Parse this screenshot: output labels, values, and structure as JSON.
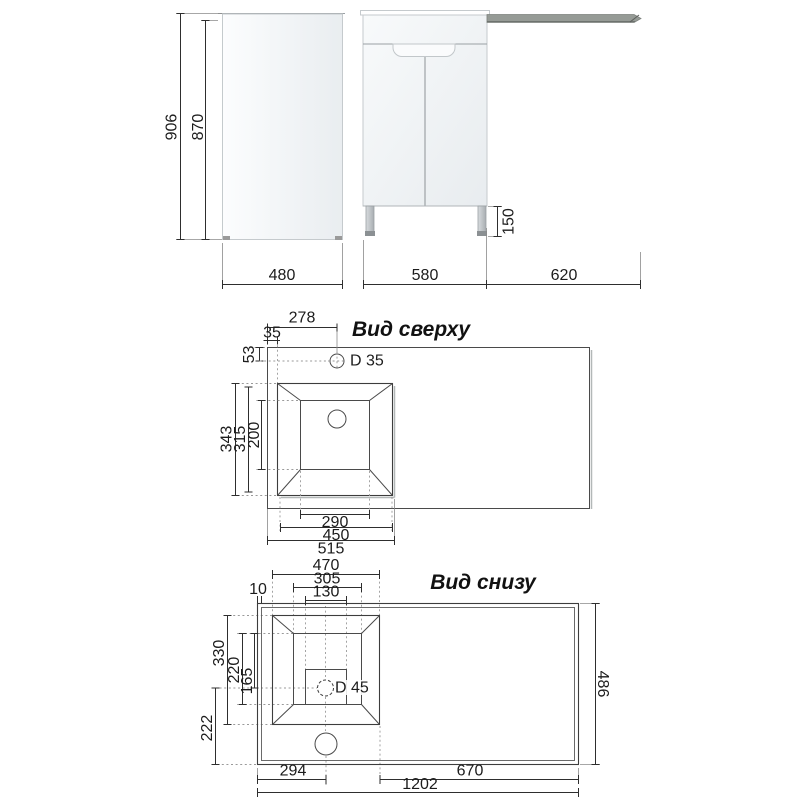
{
  "front_view": {
    "overall_height": "906",
    "cabinet_height": "870",
    "leg_height": "150",
    "side_depth": "480",
    "cabinet_width": "580",
    "worktop_wing_width": "620"
  },
  "top_view": {
    "title": "Вид сверху",
    "faucet_center_from_left": "278",
    "sink_edge_inset": "35",
    "faucet_center_from_back": "53",
    "faucet_hole_diameter": "D 35",
    "sink_outer_depth": "343",
    "sink_rim_depth": "315",
    "bowl_depth": "200",
    "bowl_width": "290",
    "sink_rim_width": "450",
    "sink_outer_width": "515"
  },
  "bottom_view": {
    "title": "Вид снизу",
    "sink_outer_width": "470",
    "bowl_width": "305",
    "drain_recess_width": "130",
    "edge_rib_offset": "10",
    "sink_outer_depth": "330",
    "bowl_depth": "220",
    "drain_from_bowl_top": "165",
    "drain_to_front_edge": "222",
    "drain_hole_diameter": "D 45",
    "worktop_depth": "486",
    "sink_offset_left": "294",
    "wing_span": "670",
    "worktop_total_width": "1202"
  },
  "colors": {
    "ink": "#333333",
    "worktop_gray": "#969b96"
  }
}
